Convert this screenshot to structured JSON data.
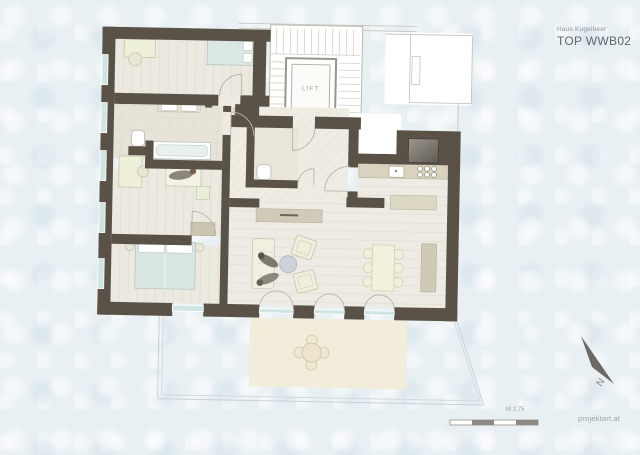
{
  "header": {
    "project": "Haus Kugelbeer",
    "unit": "TOP WWB02"
  },
  "plan": {
    "lift_label": "LIFT"
  },
  "compass": {
    "north_label": "N"
  },
  "scalebar": {
    "label": "M 1:75"
  },
  "footer": {
    "site_label": "projektart.at"
  },
  "colors": {
    "background": "#e9f0f4",
    "wall": "#5b5247",
    "floor_wood": "#ece9e0",
    "window_glass": "#cfe5e1",
    "terrace": "#f2edda",
    "furniture_cream": "#eef0d8",
    "furniture_beige": "#d0cab8",
    "bed_blue": "#d9e5e1"
  }
}
